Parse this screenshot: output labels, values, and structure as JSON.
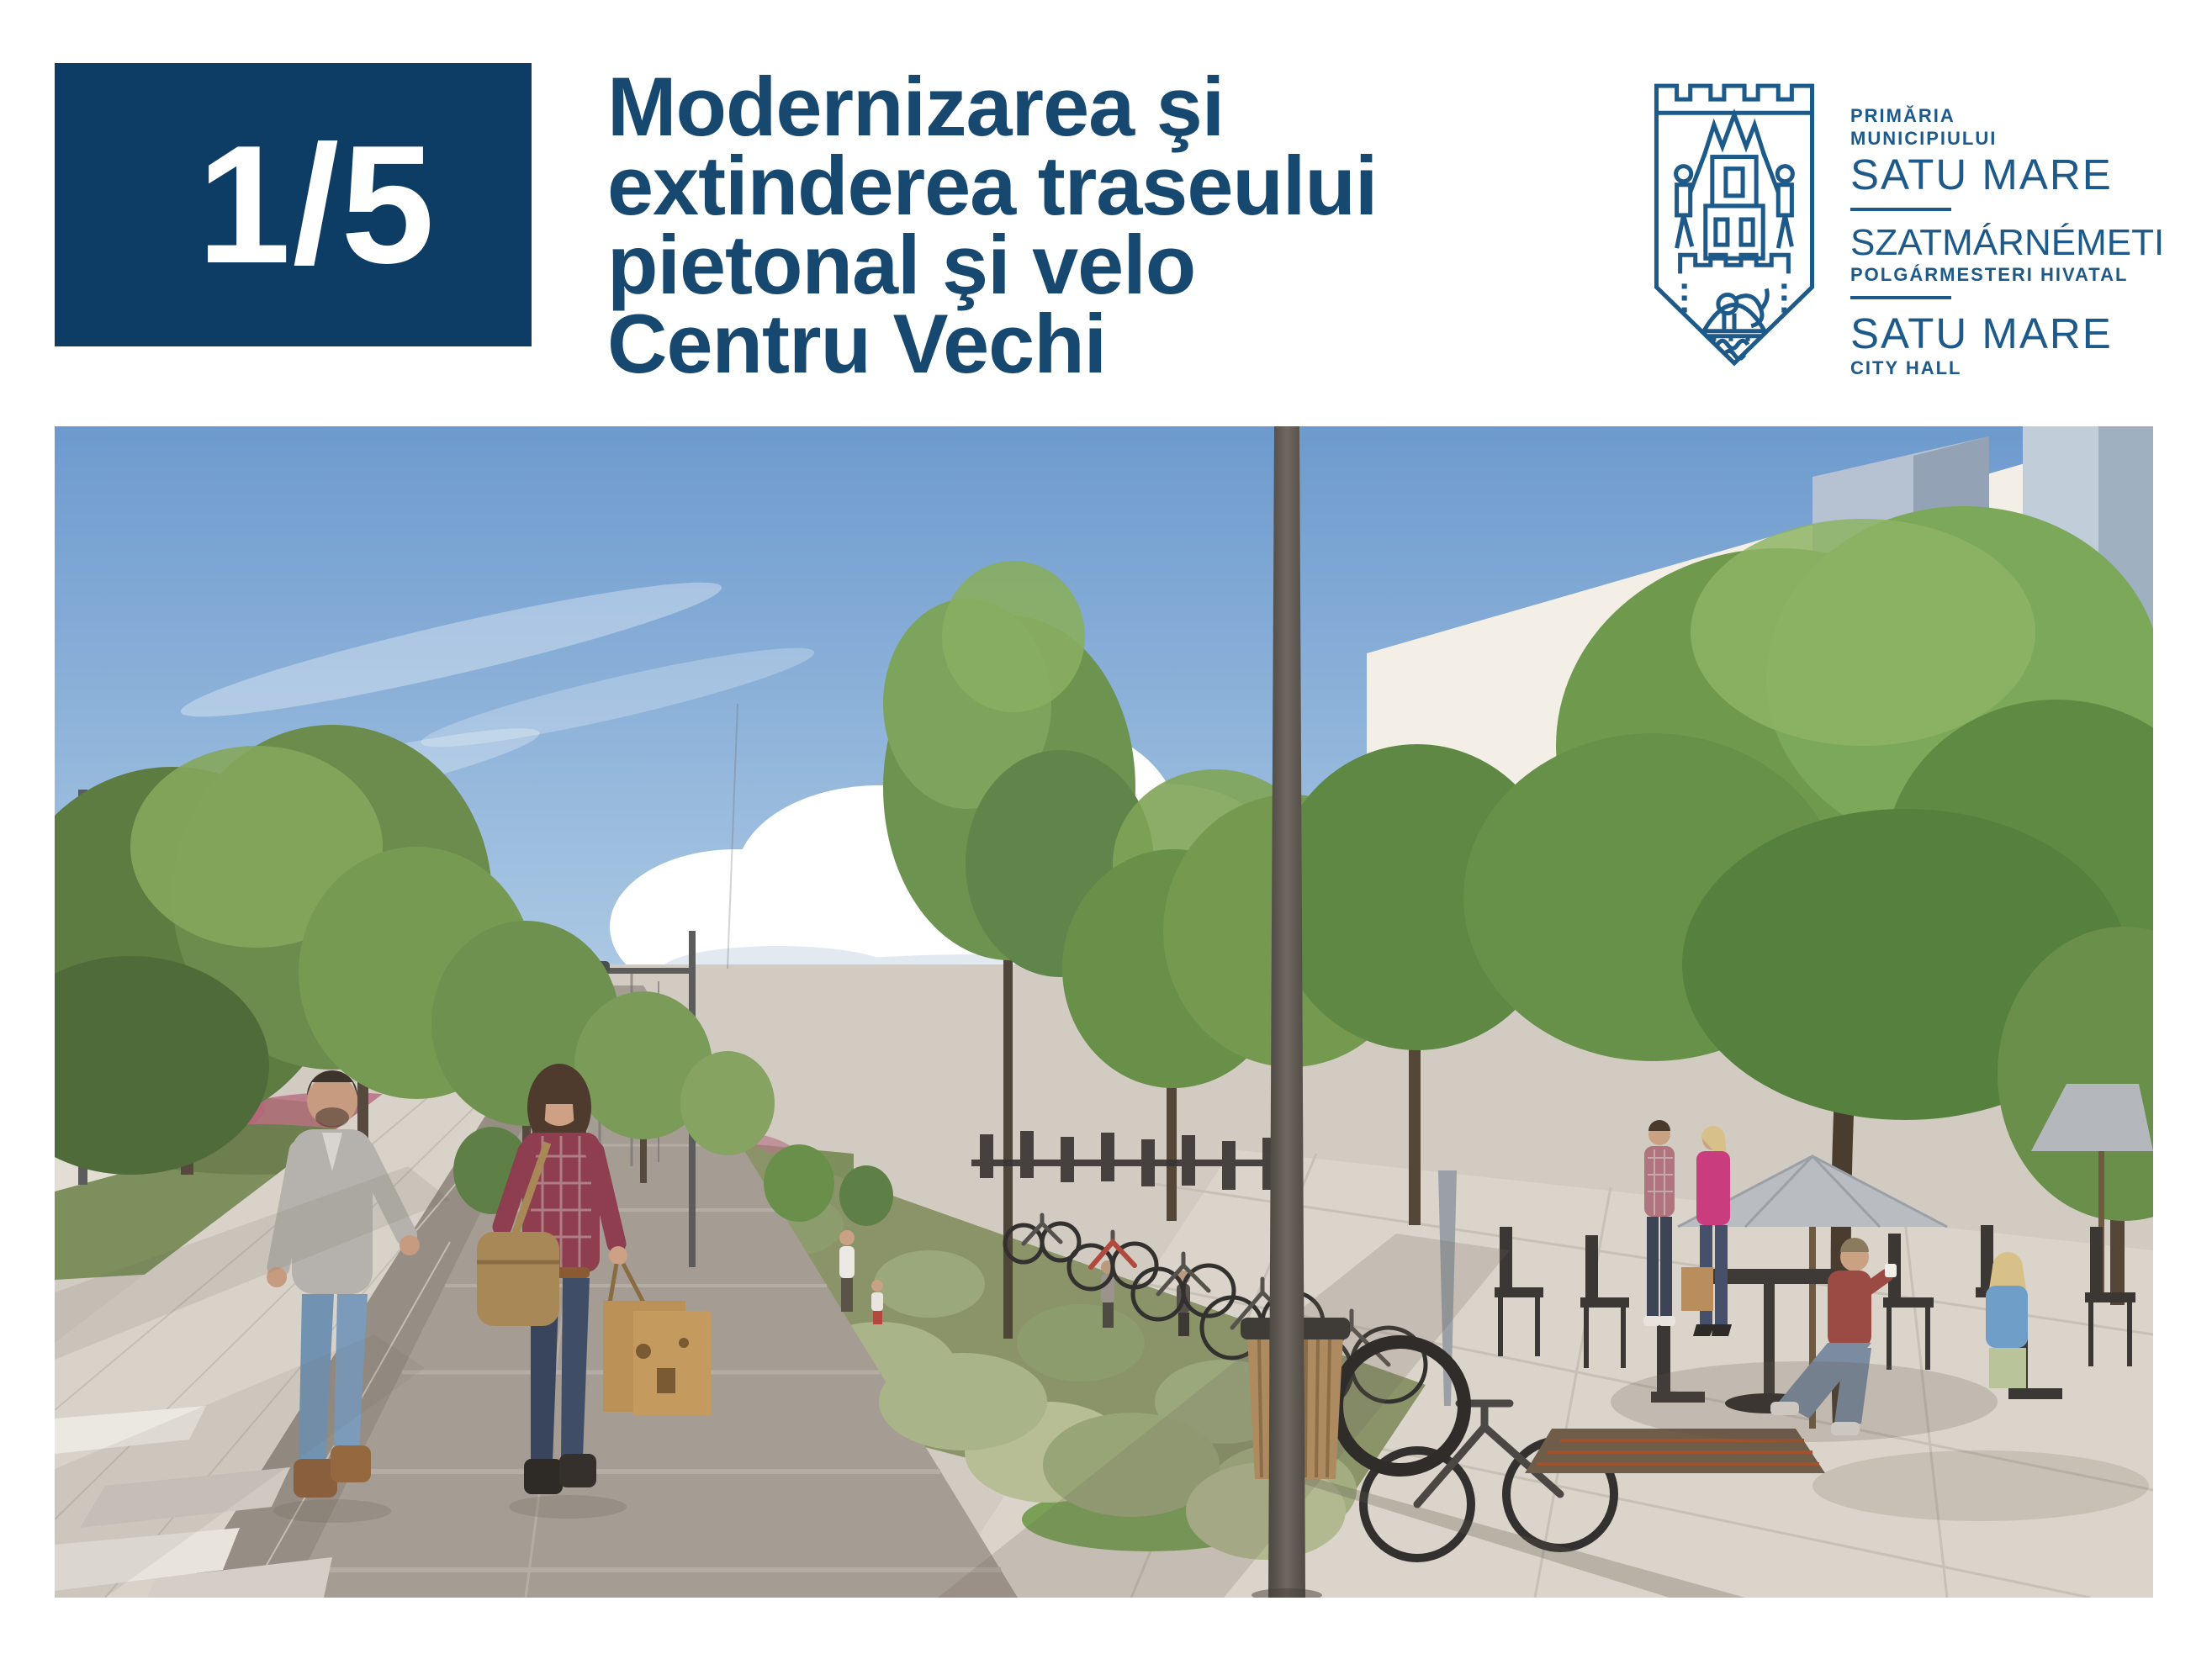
{
  "header": {
    "page_indicator": "1/5",
    "title_lines": [
      "Modernizarea şi",
      "extinderea traseului",
      "pietonal şi velo",
      "Centru Vechi"
    ],
    "title_full": "Modernizarea şi extinderea traseului pietonal şi velo Centru Vechi"
  },
  "logo": {
    "org_line1": "PRIMĂRIA",
    "org_line2": "MUNICIPIULUI",
    "org_name_ro": "SATU MARE",
    "org_name_hu": "SZATMÁRNÉMETI",
    "org_sub_hu": "POLGÁRMESTERI HIVATAL",
    "org_name_en": "SATU MARE",
    "org_sub_en": "CITY HALL"
  },
  "image": {
    "alt": "Architectural rendering of the modernized Centru Vechi pedestrian and bicycle route: a tree-lined promenade with a dark paved bike lane, ornamental grass beds, parked bicycles, a litter bin and pole, a cafe terrace with umbrellas beside a white modern building, and a couple walking with shopping bags"
  },
  "colors": {
    "accent_navy": "#0d3c64",
    "title_blue": "#17486f",
    "logo_blue": "#1d5a8a",
    "sky_top": "#6d9ace",
    "pavement": "#d2cbc2",
    "bike_path": "#a59c94",
    "foliage": "#6f9a4e"
  }
}
